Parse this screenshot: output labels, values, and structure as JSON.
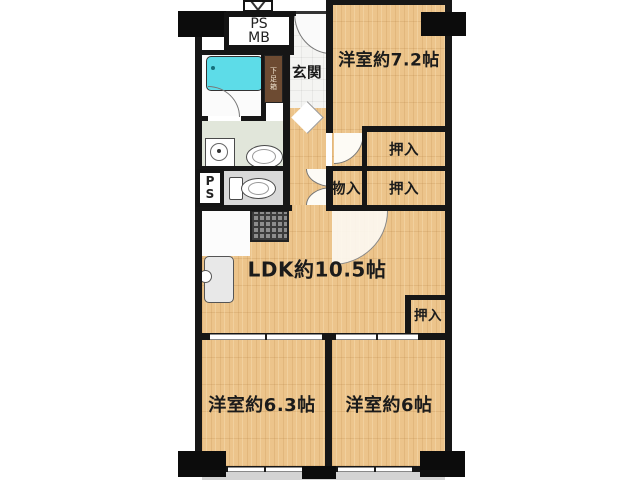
{
  "plan_type": "apartment-floor-plan",
  "rooms": {
    "bedroom1": {
      "label": "洋室約7.2帖"
    },
    "ldk": {
      "label": "LDK約10.5帖"
    },
    "bedroom2": {
      "label": "洋室約6.3帖"
    },
    "bedroom3": {
      "label": "洋室約6帖"
    },
    "entrance": {
      "label": "玄関"
    },
    "storage": {
      "label": "物入"
    },
    "closet1": {
      "label": "押入"
    },
    "closet2": {
      "label": "押入"
    },
    "closet3": {
      "label": "押入"
    },
    "shoe_box": {
      "label": "下足箱"
    },
    "ps_mb": {
      "line1": "PS",
      "line2": "MB"
    },
    "pipe_space": {
      "line1": "P",
      "line2": "S"
    }
  },
  "colors": {
    "floor_wood": "#ecc48b",
    "wall": "#161616",
    "bathtub": "#5ddce8",
    "washroom_floor": "#e1e6da",
    "toilet_floor": "#d9d9d9",
    "entrance_floor": "#f4f4f2",
    "balcony": "#d4d4d4",
    "shoe_cabinet": "#6d4b32"
  },
  "icons": {
    "bathtub-icon": "css-rounded-rect-cyan",
    "washing-machine-icon": "css-square-with-circle",
    "vanity-sink-icon": "css-ellipse",
    "toilet-icon": "css-tank-plus-bowl",
    "kitchen-sink-icon": "css-rounded-rect-with-faucet",
    "stove-icon": "css-dark-grid-square",
    "door-swing-arc": "css-quarter-circle",
    "entrance-step-marker": "css-chevron-right",
    "meter-box-door": "css-v-lines"
  }
}
